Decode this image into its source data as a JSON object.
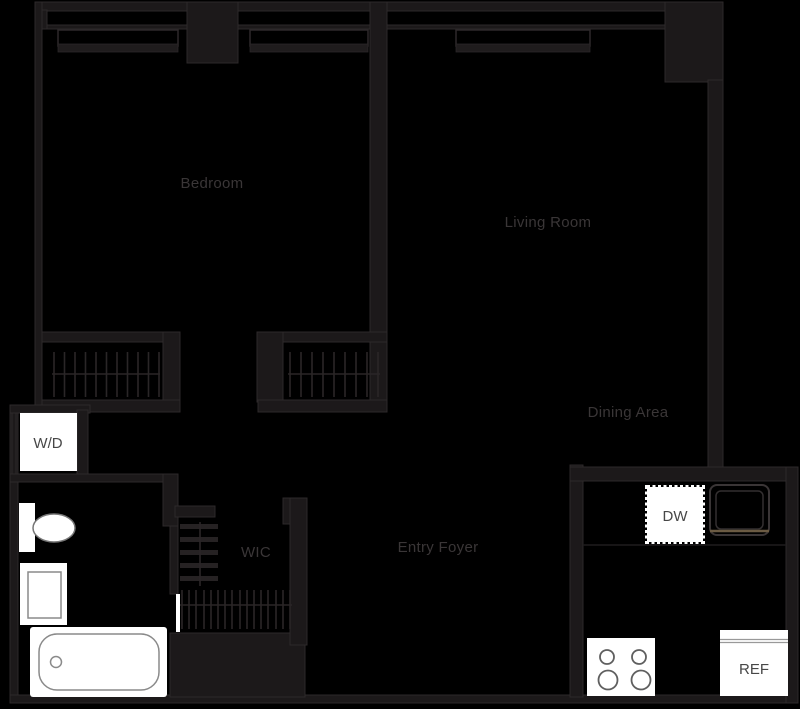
{
  "plan": {
    "type": "apartment-floor-plan",
    "rooms": {
      "bedroom": "Bedroom",
      "living_room": "Living Room",
      "dining_area": "Dining Area",
      "entry_foyer": "Entry Foyer",
      "wic": "WIC"
    },
    "appliances": {
      "washer_dryer": "W/D",
      "dishwasher": "DW",
      "refrigerator": "REF"
    },
    "colors": {
      "background": "#000000",
      "wall": "#1c191a",
      "wall_edge": "#2d292a",
      "room_label": "#3a3637",
      "appliance_label": "#474747",
      "fixture_fill": "#ffffff",
      "fixture_outline": "#8a8a8a",
      "sink_deck": "#6b5b43"
    }
  }
}
